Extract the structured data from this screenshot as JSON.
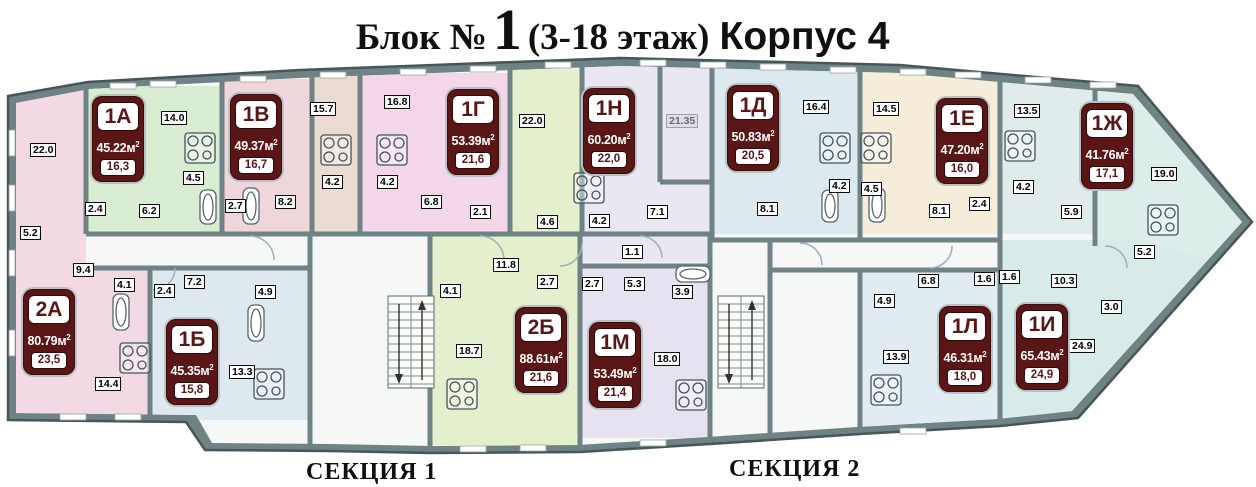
{
  "title": {
    "prefix": "Блок №",
    "number": "1",
    "suffix": "(3-18 этаж)",
    "korpus": "Корпус 4"
  },
  "sections": [
    {
      "label": "СЕКЦИЯ 1"
    },
    {
      "label": "СЕКЦИЯ 2"
    }
  ],
  "colors": {
    "badge_bg": "#5a1516",
    "badge_text": "#ffffff",
    "wall": "#6f8284"
  },
  "apartments": [
    {
      "label": "1А",
      "area": "45.22м",
      "area_sup": "2",
      "living": "16,3",
      "x": 92,
      "y": 96,
      "color": "#d7ecd0"
    },
    {
      "label": "1В",
      "area": "49.37м",
      "area_sup": "2",
      "living": "16,7",
      "x": 230,
      "y": 94,
      "color": "#efd6da"
    },
    {
      "label": "1Г",
      "area": "53.39м",
      "area_sup": "2",
      "living": "21,6",
      "x": 447,
      "y": 89,
      "color": "#f4d6e9"
    },
    {
      "label": "1Н",
      "area": "60.20м",
      "area_sup": "2",
      "living": "22,0",
      "x": 583,
      "y": 88,
      "color": "#e9e7f2"
    },
    {
      "label": "1Д",
      "area": "50.83м",
      "area_sup": "2",
      "living": "20,5",
      "x": 727,
      "y": 85,
      "color": "#dceaf0"
    },
    {
      "label": "1Е",
      "area": "47.20м",
      "area_sup": "2",
      "living": "16,0",
      "x": 936,
      "y": 98,
      "color": "#f5edda"
    },
    {
      "label": "1Ж",
      "area": "41.76м",
      "area_sup": "2",
      "living": "17,1",
      "x": 1081,
      "y": 103,
      "color": "#dcedea"
    },
    {
      "label": "2А",
      "area": "80.79м",
      "area_sup": "2",
      "living": "23,5",
      "x": 23,
      "y": 289,
      "color": "#f3d9e3"
    },
    {
      "label": "1Б",
      "area": "45.35м",
      "area_sup": "2",
      "living": "15,8",
      "x": 166,
      "y": 319,
      "color": "#dee8ef"
    },
    {
      "label": "2Б",
      "area": "88.61м",
      "area_sup": "2",
      "living": "21,6",
      "x": 515,
      "y": 307,
      "color": "#e4efcd"
    },
    {
      "label": "1М",
      "area": "53.49м",
      "area_sup": "2",
      "living": "21,4",
      "x": 589,
      "y": 322,
      "color": "#e6e2ef"
    },
    {
      "label": "1Л",
      "area": "46.31м",
      "area_sup": "2",
      "living": "18,0",
      "x": 939,
      "y": 306,
      "color": "#e1ecf2"
    },
    {
      "label": "1И",
      "area": "65.43м",
      "area_sup": "2",
      "living": "24,9",
      "x": 1016,
      "y": 304,
      "color": "#d9ebe8"
    }
  ],
  "rooms": [
    {
      "t": "22.0",
      "x": 30,
      "y": 143
    },
    {
      "t": "14.0",
      "x": 161,
      "y": 111
    },
    {
      "t": "4.5",
      "x": 183,
      "y": 171
    },
    {
      "t": "2.4",
      "x": 85,
      "y": 202
    },
    {
      "t": "6.2",
      "x": 139,
      "y": 204
    },
    {
      "t": "5.2",
      "x": 20,
      "y": 226
    },
    {
      "t": "9.4",
      "x": 73,
      "y": 263
    },
    {
      "t": "2.7",
      "x": 225,
      "y": 199
    },
    {
      "t": "8.2",
      "x": 275,
      "y": 195
    },
    {
      "t": "15.7",
      "x": 310,
      "y": 102
    },
    {
      "t": "16.8",
      "x": 384,
      "y": 95
    },
    {
      "t": "4.2",
      "x": 322,
      "y": 175
    },
    {
      "t": "4.2",
      "x": 377,
      "y": 175
    },
    {
      "t": "6.8",
      "x": 421,
      "y": 195
    },
    {
      "t": "2.1",
      "x": 470,
      "y": 205
    },
    {
      "t": "22.0",
      "x": 519,
      "y": 114
    },
    {
      "t": "4.6",
      "x": 537,
      "y": 215
    },
    {
      "t": "11.8",
      "x": 493,
      "y": 258
    },
    {
      "t": "2.7",
      "x": 537,
      "y": 275
    },
    {
      "t": "21.35",
      "x": 666,
      "y": 114,
      "faint": true
    },
    {
      "t": "4.2",
      "x": 589,
      "y": 214
    },
    {
      "t": "7.1",
      "x": 647,
      "y": 205
    },
    {
      "t": "1.1",
      "x": 622,
      "y": 245
    },
    {
      "t": "16.4",
      "x": 803,
      "y": 100
    },
    {
      "t": "8.1",
      "x": 757,
      "y": 202
    },
    {
      "t": "4.2",
      "x": 829,
      "y": 179
    },
    {
      "t": "4.5",
      "x": 861,
      "y": 182
    },
    {
      "t": "14.5",
      "x": 873,
      "y": 102
    },
    {
      "t": "2.4",
      "x": 969,
      "y": 197
    },
    {
      "t": "8.1",
      "x": 929,
      "y": 204
    },
    {
      "t": "13.5",
      "x": 1014,
      "y": 104
    },
    {
      "t": "4.2",
      "x": 1013,
      "y": 180
    },
    {
      "t": "5.9",
      "x": 1061,
      "y": 205
    },
    {
      "t": "19.0",
      "x": 1151,
      "y": 167
    },
    {
      "t": "5.2",
      "x": 1134,
      "y": 245
    },
    {
      "t": "4.1",
      "x": 114,
      "y": 278
    },
    {
      "t": "2.4",
      "x": 154,
      "y": 284
    },
    {
      "t": "7.2",
      "x": 184,
      "y": 275
    },
    {
      "t": "4.9",
      "x": 255,
      "y": 285
    },
    {
      "t": "13.3",
      "x": 229,
      "y": 365
    },
    {
      "t": "14.4",
      "x": 95,
      "y": 377
    },
    {
      "t": "4.1",
      "x": 440,
      "y": 284
    },
    {
      "t": "18.7",
      "x": 456,
      "y": 344
    },
    {
      "t": "2.7",
      "x": 582,
      "y": 277
    },
    {
      "t": "5.3",
      "x": 624,
      "y": 277
    },
    {
      "t": "3.9",
      "x": 672,
      "y": 285
    },
    {
      "t": "18.0",
      "x": 654,
      "y": 352
    },
    {
      "t": "6.8",
      "x": 918,
      "y": 274
    },
    {
      "t": "4.9",
      "x": 874,
      "y": 294
    },
    {
      "t": "1.6",
      "x": 974,
      "y": 272
    },
    {
      "t": "1.6",
      "x": 999,
      "y": 270
    },
    {
      "t": "13.9",
      "x": 883,
      "y": 350
    },
    {
      "t": "10.3",
      "x": 1051,
      "y": 274
    },
    {
      "t": "3.0",
      "x": 1101,
      "y": 300
    },
    {
      "t": "24.9",
      "x": 1069,
      "y": 339
    }
  ]
}
